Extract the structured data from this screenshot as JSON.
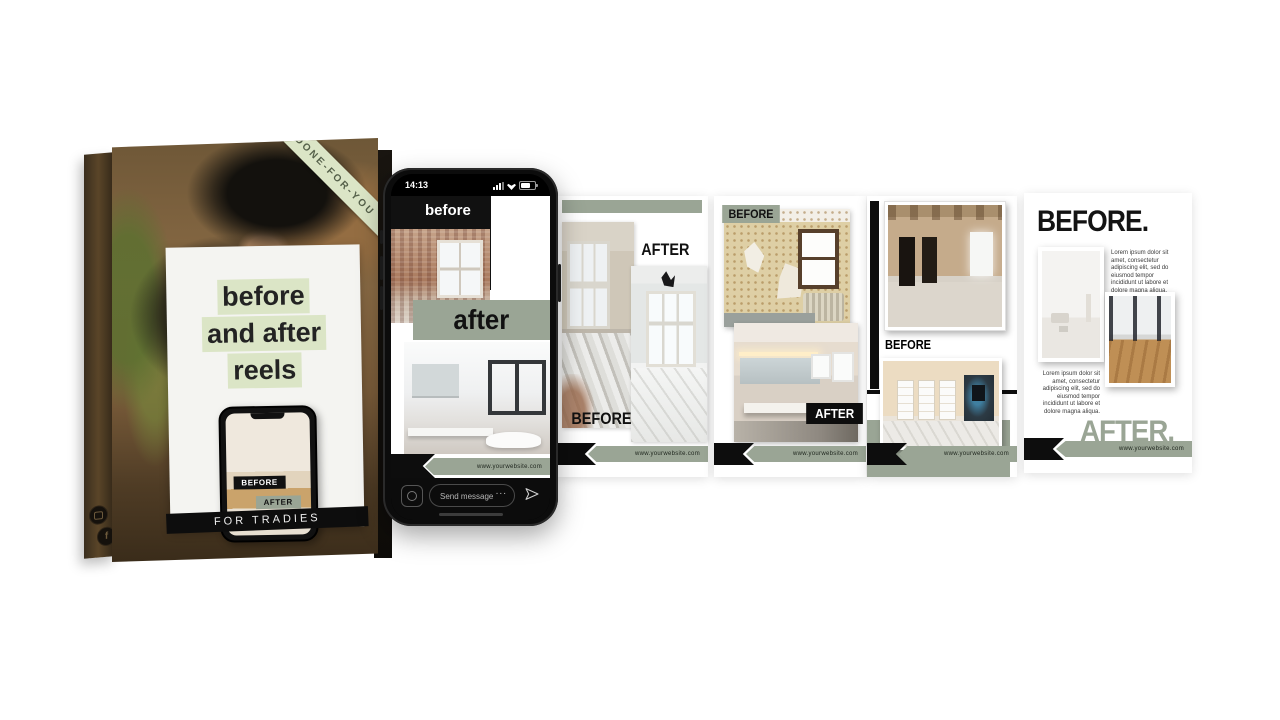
{
  "colors": {
    "sage": "#9aa595",
    "light_green": "#dbe5c6",
    "ink": "#0d0d0d"
  },
  "box": {
    "ribbon_label": "DONE-FOR-YOU",
    "title_line1": "before",
    "title_line2": "and after",
    "title_line3": "reels",
    "mini_phone": {
      "before_label": "BEFORE",
      "after_label": "AFTER"
    },
    "footer_label": "FOR TRADIES"
  },
  "phone": {
    "status_time": "14:13",
    "before_label": "before",
    "after_label": "after",
    "website": "www.yourwebsite.com",
    "send_message_placeholder": "Send message",
    "more_label": "..."
  },
  "templates": [
    {
      "before_label": "BEFORE",
      "after_label": "AFTER",
      "website": "www.yourwebsite.com"
    },
    {
      "before_label": "BEFORE",
      "after_label": "AFTER",
      "website": "www.yourwebsite.com"
    },
    {
      "before_label": "BEFORE",
      "after_label": "AFTER",
      "website": "www.yourwebsite.com"
    },
    {
      "before_heading": "BEFORE.",
      "after_heading": "AFTER.",
      "body_text": "Lorem ipsum dolor sit amet, consectetur adipiscing elit, sed do eiusmod tempor incididunt ut labore et dolore magna aliqua.",
      "body_text_2": "Lorem ipsum dolor sit amet, consectetur adipiscing elit, sed do eiusmod tempor incididunt ut labore et dolore magna aliqua.",
      "website": "www.yourwebsite.com"
    }
  ]
}
